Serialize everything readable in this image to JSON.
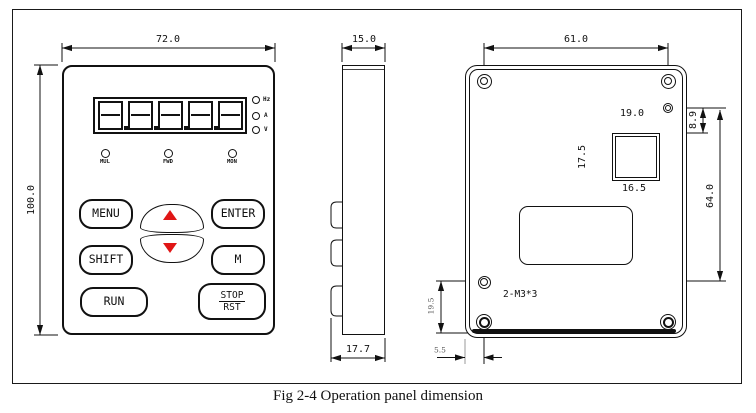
{
  "caption": "Fig 2-4 Operation panel dimension",
  "colors": {
    "line": "#1a1a1a",
    "arrow_red": "#e01616"
  },
  "front_view": {
    "dim_width": "72.0",
    "dim_height": "100.0",
    "indicators": [
      "Hz",
      "A",
      "V"
    ],
    "status_leds": [
      "MUL",
      "FWD",
      "MON"
    ],
    "buttons": {
      "menu": "MENU",
      "enter": "ENTER",
      "shift": "SHIFT",
      "m": "M",
      "run": "RUN",
      "stop": "STOP",
      "rst": "RST"
    }
  },
  "side_view": {
    "dim_depth": "15.0",
    "dim_bottom_depth": "17.7"
  },
  "back_view": {
    "dim_hole_span": "61.0",
    "dim_rj45_to_screw": "19.0",
    "dim_screw_drop": "8.9",
    "dim_rj45_height": "17.5",
    "dim_rj45_width": "16.5",
    "dim_hole_vertical": "64.0",
    "dim_bottom_section": "19.5",
    "dim_edge_offset": "5.5",
    "screw_note": "2-M3*3"
  }
}
